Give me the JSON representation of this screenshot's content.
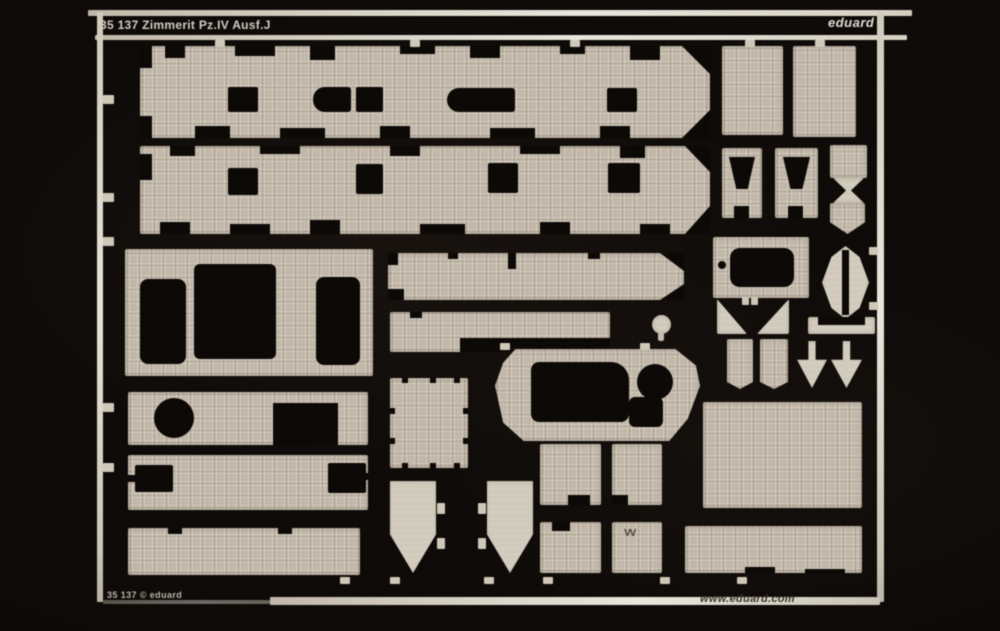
{
  "photo": {
    "header": {
      "catalog_title": "35 137 Zimmerit Pz.IV Ausf.J",
      "brand_logo": "eduard"
    },
    "footer": {
      "left_text": "35 137 © eduard",
      "website": "www.eduard.com"
    },
    "sheet": {
      "etched_mark": "VV",
      "colors": {
        "background": "#0d0a08",
        "brass": "#c7beaf",
        "brass_light": "#d8d2c4",
        "frame_white": "#f2efe6",
        "header_text": "#d9d4c9",
        "website_text": "#3e362c"
      }
    }
  }
}
